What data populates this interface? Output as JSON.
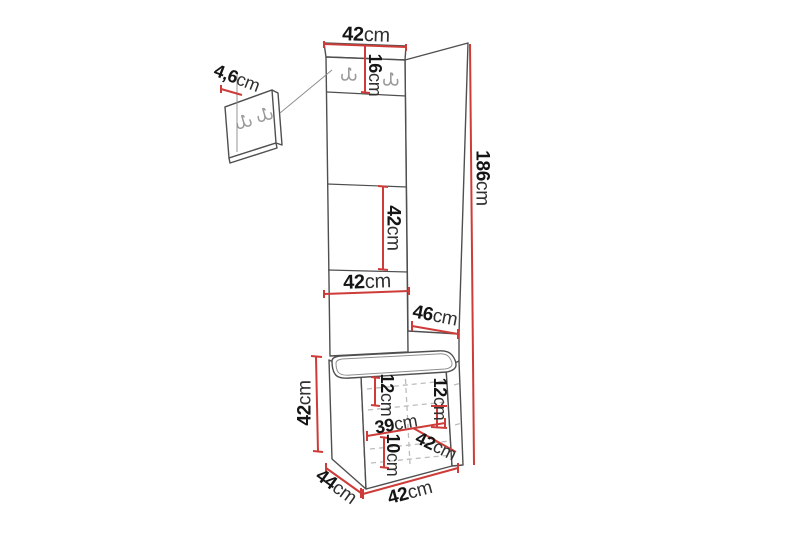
{
  "diagram": {
    "type": "furniture-dimension-diagram",
    "subject": "hallway set: tall upholstered panel with coat hooks and storage bench",
    "dimension_line_color": "#cd3c38",
    "outline_color": "#4f4f4f",
    "dimensions": {
      "top_width": {
        "value": "42",
        "unit": "cm"
      },
      "hook_panel_height": {
        "value": "16",
        "unit": "cm"
      },
      "hook_plate_depth": {
        "value": "4,6",
        "unit": "cm"
      },
      "total_height": {
        "value": "186",
        "unit": "cm"
      },
      "middle_panel_height": {
        "value": "42",
        "unit": "cm"
      },
      "panel_width": {
        "value": "42",
        "unit": "cm"
      },
      "side_panel_depth": {
        "value": "46",
        "unit": "cm"
      },
      "bench_height": {
        "value": "42",
        "unit": "cm"
      },
      "bench_top_inset": {
        "value": "12",
        "unit": "cm"
      },
      "bench_side_inset": {
        "value": "12",
        "unit": "cm"
      },
      "bench_inner_width": {
        "value": "39",
        "unit": "cm"
      },
      "bench_bottom_inset": {
        "value": "10",
        "unit": "cm"
      },
      "bench_diagonal": {
        "value": "42",
        "unit": "cm"
      },
      "bench_depth": {
        "value": "44",
        "unit": "cm"
      },
      "bench_width": {
        "value": "42",
        "unit": "cm"
      }
    }
  }
}
